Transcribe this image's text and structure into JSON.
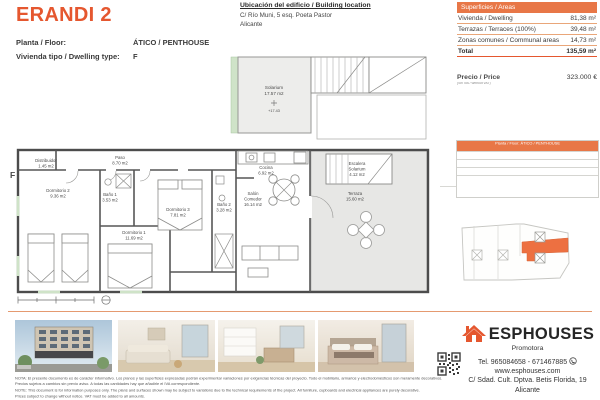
{
  "colors": {
    "accent": "#e5572f",
    "accent_light": "#e87747",
    "key_unit_orange": "#ed7041",
    "plan_green": "#cfe3c8"
  },
  "header": {
    "title": "ERANDI 2",
    "floor_label": "Planta / Floor:",
    "floor_value": "ÁTICO / PENTHOUSE",
    "type_label": "Vivienda tipo / Dwelling type:",
    "type_value": "F"
  },
  "location": {
    "title": "Ubicación del edificio / Building location",
    "line1": "C/ Río Muni, 5 esq. Poeta Pastor",
    "line2": "Alicante"
  },
  "areas": {
    "header": "Superficies / Areas",
    "rows": [
      {
        "label": "Vivienda / Dwelling",
        "value": "81,38 m²"
      },
      {
        "label": "Terrazas / Terraces (100%)",
        "value": "39,48 m²"
      },
      {
        "label": "Zonas comunes / Communal areas",
        "value": "14,73 m²"
      }
    ],
    "total_label": "Total",
    "total_value": "135,59 m²"
  },
  "price": {
    "label": "Precio / Price",
    "note": "(Sin IVA / Without VAT)",
    "value": "323.000 €"
  },
  "plan": {
    "unit": "F",
    "distribuidor": {
      "n": "Distribuidor",
      "a": "1.45 m2"
    },
    "paso": {
      "n": "Paso",
      "a": "8.70 m2"
    },
    "dorm2": {
      "n": "Dormitorio 2",
      "a": "9.36 m2"
    },
    "bano1": {
      "n": "Baño 1",
      "a": "3.53 m2"
    },
    "dorm1": {
      "n": "Dormitorio 1",
      "a": "11.69 m2"
    },
    "dorm3": {
      "n": "Dormitorio 3",
      "a": "7.81 m2"
    },
    "bano2": {
      "n": "Baño 2",
      "a": "3.28 m2"
    },
    "cocina": {
      "n": "Cocina",
      "a": "6.92 m2"
    },
    "salon": {
      "l1": "Salón",
      "l2": "Comedor",
      "a": "16.14 m2"
    },
    "terraza": {
      "n": "Terraza",
      "a": "15.60 m2"
    },
    "escalera": {
      "l1": "Escalera",
      "l2": "Solarium",
      "a": "4.12 m2"
    },
    "solarium": {
      "n": "Solarium",
      "a": "17.57 m2",
      "level": "+17.43"
    }
  },
  "key_table": {
    "header": "Planta / Floor: ÁTICO / PENTHOUSE"
  },
  "footer": {
    "line1": "NOTA: El presente documento es de carácter informativo. Los planos y las superficies expresadas podrán experimentar variaciones por exigencias técnicas del proyecto. Todo el mobiliario, armarios y electrodomésticos son meramente decorativos.",
    "line2": "Precios sujetos a cambios sin previo aviso. A todas las cantidades hay que añadirle el IVA correspondiente.",
    "line3": "NOTE: This document is for information purposes only. The plans and surfaces shown may be subject to variations due to the technical requirements of the project. All furniture, cupboards and electrical appliances are purely decorative.",
    "line4": "Prices subject to change without notice. VAT must be added to all amounts."
  },
  "brand": {
    "name": "ESPHOUSES",
    "tagline": "Promotora",
    "phone": "Tel. 965084658 - 671467885",
    "web": "www.esphouses.com",
    "address1": "C/ Sdad. Cult. Dptva. Betis Florida, 19",
    "address2": "Alicante"
  }
}
